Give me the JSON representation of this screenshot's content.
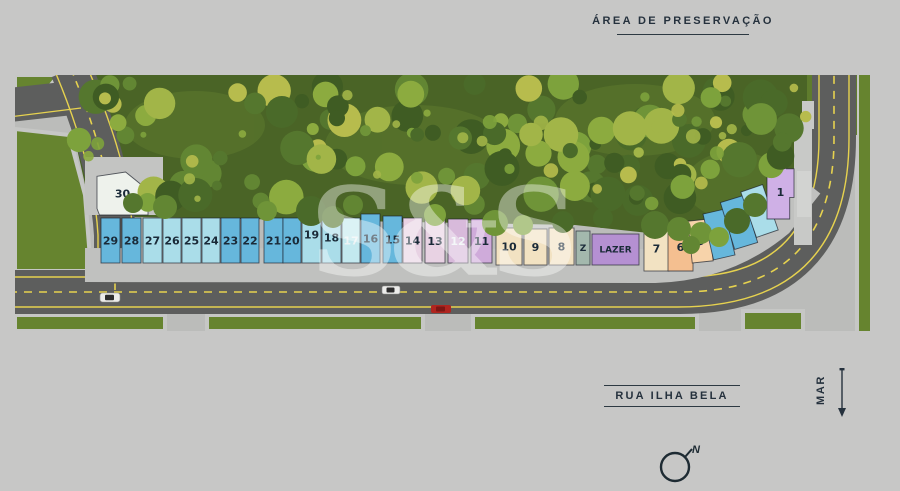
{
  "labels": {
    "preservation": "ÁREA DE PRESERVAÇÃO",
    "street": "RUA ILHA BELA",
    "sea": "MAR",
    "compass_north": "N",
    "watermark": "S&S"
  },
  "colors": {
    "background": "#c7c7c6",
    "road": "#5d5e5d",
    "lane_marking": "#e6d24f",
    "lawn": "#66842f",
    "forest": "#4a6426",
    "sidewalk": "#bebfbd",
    "label_text": "#25313d",
    "lot_text_dark": "#1a2a38",
    "lot_text_light": "#edf3f5"
  },
  "lots": [
    {
      "label": "30",
      "x": 82,
      "y": 97,
      "w": 51,
      "h": 43,
      "fill": "#eef2ec",
      "shape": "lot30"
    },
    {
      "label": "29",
      "x": 86,
      "y": 143,
      "w": 19,
      "h": 45,
      "fill": "#66b7dc"
    },
    {
      "label": "28",
      "x": 107,
      "y": 143,
      "w": 19,
      "h": 45,
      "fill": "#66b7dc"
    },
    {
      "label": "27",
      "x": 128,
      "y": 143,
      "w": 19,
      "h": 45,
      "fill": "#aadde9"
    },
    {
      "label": "26",
      "x": 148,
      "y": 143,
      "w": 18,
      "h": 45,
      "fill": "#aadde9"
    },
    {
      "label": "25",
      "x": 167,
      "y": 143,
      "w": 19,
      "h": 45,
      "fill": "#aadde9"
    },
    {
      "label": "24",
      "x": 187,
      "y": 143,
      "w": 18,
      "h": 45,
      "fill": "#aadde9"
    },
    {
      "label": "23",
      "x": 206,
      "y": 143,
      "w": 19,
      "h": 45,
      "fill": "#66b7dc"
    },
    {
      "label": "22",
      "x": 226,
      "y": 143,
      "w": 18,
      "h": 45,
      "fill": "#66b7dc"
    },
    {
      "label": "21",
      "x": 249,
      "y": 143,
      "w": 19,
      "h": 45,
      "fill": "#66b7dc"
    },
    {
      "label": "20",
      "x": 268,
      "y": 143,
      "w": 18,
      "h": 45,
      "fill": "#66b7dc"
    },
    {
      "label": "19",
      "x": 287,
      "y": 131,
      "w": 19,
      "h": 57,
      "fill": "#aadde9"
    },
    {
      "label": "18",
      "x": 307,
      "y": 137,
      "w": 19,
      "h": 51,
      "fill": "#aadde9"
    },
    {
      "label": "17",
      "x": 327,
      "y": 143,
      "w": 18,
      "h": 45,
      "fill": "#c3e9ef",
      "text_fill": "#edf3f5"
    },
    {
      "label": "16",
      "x": 346,
      "y": 139,
      "w": 19,
      "h": 49,
      "fill": "#66b7dc"
    },
    {
      "label": "15",
      "x": 368,
      "y": 141,
      "w": 19,
      "h": 47,
      "fill": "#66b7dc"
    },
    {
      "label": "14",
      "x": 388,
      "y": 143,
      "w": 19,
      "h": 45,
      "fill": "#e8d2e3"
    },
    {
      "label": "13",
      "x": 410,
      "y": 144,
      "w": 20,
      "h": 44,
      "fill": "#e8d2e3"
    },
    {
      "label": "12",
      "x": 433,
      "y": 144,
      "w": 20,
      "h": 44,
      "fill": "#d8badb",
      "text_fill": "#edf3f5"
    },
    {
      "label": "11",
      "x": 456,
      "y": 144,
      "w": 21,
      "h": 44,
      "fill": "#cfabda"
    },
    {
      "label": "10",
      "x": 481,
      "y": 153,
      "w": 26,
      "h": 37,
      "fill": "#f2e2c2"
    },
    {
      "label": "9",
      "x": 509,
      "y": 154,
      "w": 23,
      "h": 36,
      "fill": "#f2e2c2"
    },
    {
      "label": "8",
      "x": 534,
      "y": 153,
      "w": 25,
      "h": 37,
      "fill": "#f2e2c2"
    },
    {
      "label": "Z",
      "x": 561,
      "y": 156,
      "w": 14,
      "h": 34,
      "fill": "#a3b8ad",
      "fs": 9
    },
    {
      "label": "LAZER",
      "x": 577,
      "y": 159,
      "w": 47,
      "h": 31,
      "fill": "#b590d2",
      "fs": 9
    },
    {
      "label": "7",
      "x": 629,
      "y": 151,
      "w": 25,
      "h": 45,
      "fill": "#f2e2c2"
    },
    {
      "label": "6",
      "x": 653,
      "y": 148,
      "w": 25,
      "h": 48,
      "fill": "#f4bf90",
      "shape": "notchtop"
    },
    {
      "label": "5",
      "x": 675,
      "y": 145,
      "w": 21,
      "h": 42,
      "fill": "#f7d3aa",
      "rot": -6
    },
    {
      "label": "4",
      "x": 693,
      "y": 136,
      "w": 22,
      "h": 47,
      "fill": "#66b7dc",
      "rot": -13
    },
    {
      "label": "3",
      "x": 712,
      "y": 123,
      "w": 24,
      "h": 49,
      "fill": "#66b7dc",
      "rot": -17
    },
    {
      "label": "2",
      "x": 733,
      "y": 112,
      "w": 23,
      "h": 48,
      "fill": "#aadde9",
      "rot": -19
    },
    {
      "label": "1",
      "x": 752,
      "y": 90,
      "w": 27,
      "h": 54,
      "fill": "#cfb0e6",
      "shape": "notchright"
    }
  ]
}
